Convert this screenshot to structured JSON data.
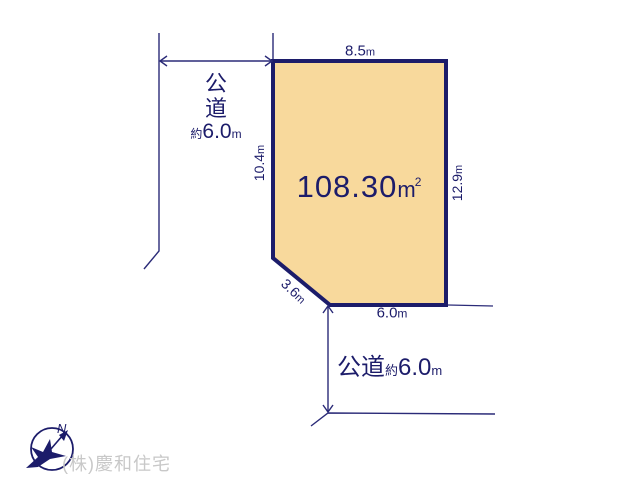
{
  "diagram": {
    "plot": {
      "area_value": "108.30",
      "area_unit": "m",
      "area_sup": "2"
    },
    "dimensions": {
      "top": {
        "value": "8.5",
        "unit": "m"
      },
      "left": {
        "value": "10.4",
        "unit": "m"
      },
      "right": {
        "value": "12.9",
        "unit": "m"
      },
      "corner": {
        "value": "3.6",
        "unit": "m"
      },
      "bottom": {
        "value": "6.0",
        "unit": "m"
      }
    },
    "roads": {
      "west": {
        "name": "公\n道",
        "approx": "約",
        "width": "6.0",
        "unit": "m"
      },
      "south": {
        "name": "公道",
        "approx": "約",
        "width": "6.0",
        "unit": "m"
      }
    },
    "compass": {
      "north_label": "N"
    },
    "credit": "(株)慶和住宅"
  },
  "colors": {
    "plot_fill": "#f8d99c",
    "border_navy": "#1c1c6a",
    "line_navy": "#2b2b78",
    "credit_gray": "#c8c8c8"
  }
}
